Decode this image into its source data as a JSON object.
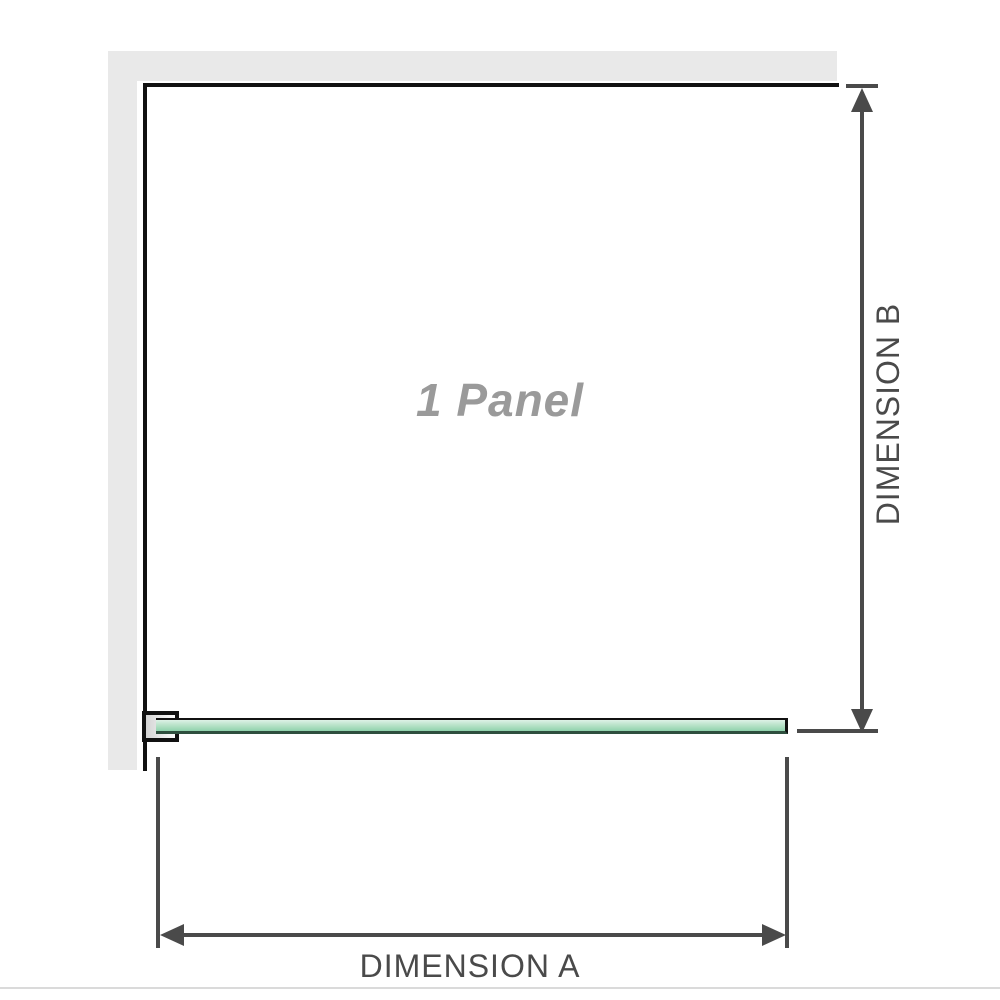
{
  "diagram": {
    "title": "shower-screen-1-panel-dimension-diagram",
    "panel_label": "1 Panel",
    "dimension_a": {
      "label": "DIMENSION A",
      "orientation": "horizontal",
      "measures": "panel width"
    },
    "dimension_b": {
      "label": "DIMENSION B",
      "orientation": "vertical",
      "measures": "panel height"
    }
  },
  "colors": {
    "background": "#ffffff",
    "wall": "#e9e9e9",
    "outline": "#111111",
    "dimension": "#4a4a4a",
    "panel_label_text": "#9a9a9a",
    "glass_light": "#ddf1e6",
    "glass_mid": "#b2e0c4",
    "glass_deep": "#8fd2ad",
    "glass_edge": "#2e4f3e",
    "bracket_fill_from": "#d4d4d4",
    "bracket_fill_to": "#fcfcfc",
    "separator": "#dadada"
  }
}
